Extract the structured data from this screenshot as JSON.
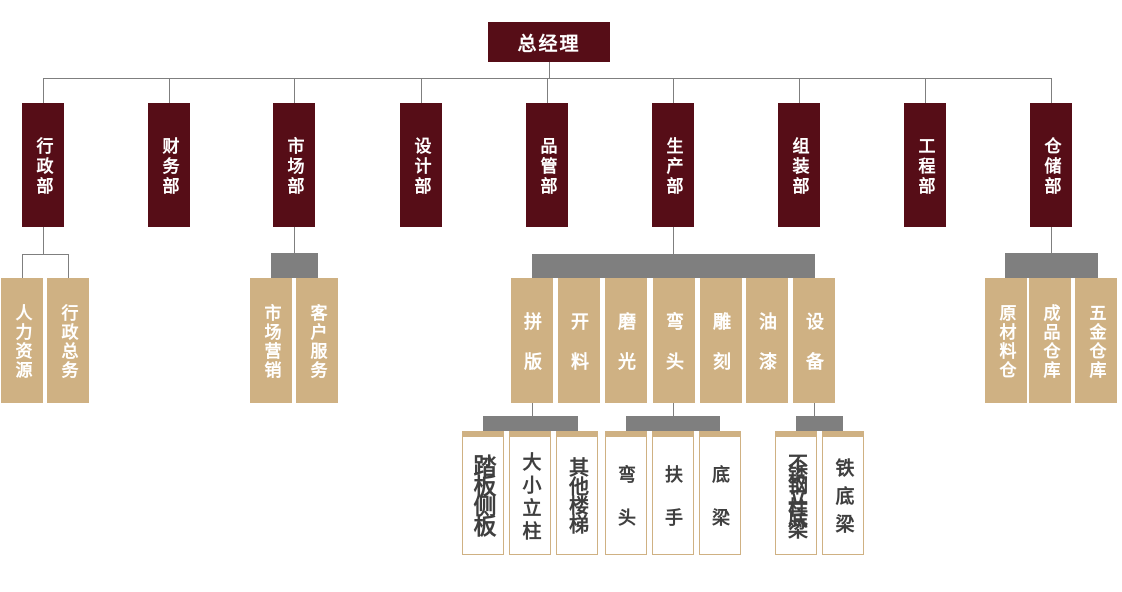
{
  "root": {
    "label": "总经理"
  },
  "departments": [
    {
      "label": "行政部"
    },
    {
      "label": "财务部"
    },
    {
      "label": "市场部"
    },
    {
      "label": "设计部"
    },
    {
      "label": "品管部"
    },
    {
      "label": "生产部"
    },
    {
      "label": "组装部"
    },
    {
      "label": "工程部"
    },
    {
      "label": "仓储部"
    }
  ],
  "admin_children": [
    {
      "label": "人力资源"
    },
    {
      "label": "行政总务"
    }
  ],
  "market_children": [
    {
      "label": "市场营销"
    },
    {
      "label": "客户服务"
    }
  ],
  "production_children": [
    {
      "label": "拼版"
    },
    {
      "label": "开料"
    },
    {
      "label": "磨光"
    },
    {
      "label": "弯头"
    },
    {
      "label": "雕刻"
    },
    {
      "label": "油漆"
    },
    {
      "label": "设备"
    }
  ],
  "warehouse_children": [
    {
      "label": "原材料仓"
    },
    {
      "label": "成品仓库"
    },
    {
      "label": "五金仓库"
    }
  ],
  "panel_leaves": [
    {
      "label": "踏板侧板"
    },
    {
      "label": "大小立柱"
    },
    {
      "label": "其他楼梯"
    }
  ],
  "elbow_leaves": [
    {
      "label": "弯头"
    },
    {
      "label": "扶手"
    },
    {
      "label": "底梁"
    }
  ],
  "equipment_leaves": [
    {
      "label": "不锈钢立柱底梁"
    },
    {
      "label": "铁底梁"
    }
  ],
  "colors": {
    "dept_box": "#560d17",
    "team_box": "#cfb183",
    "connector_bar": "#7f7f7f",
    "connector_line": "#7f7f7f",
    "leaf_border": "#cfb183",
    "leaf_text": "#3f3f3f",
    "box_text": "#ffffff"
  }
}
